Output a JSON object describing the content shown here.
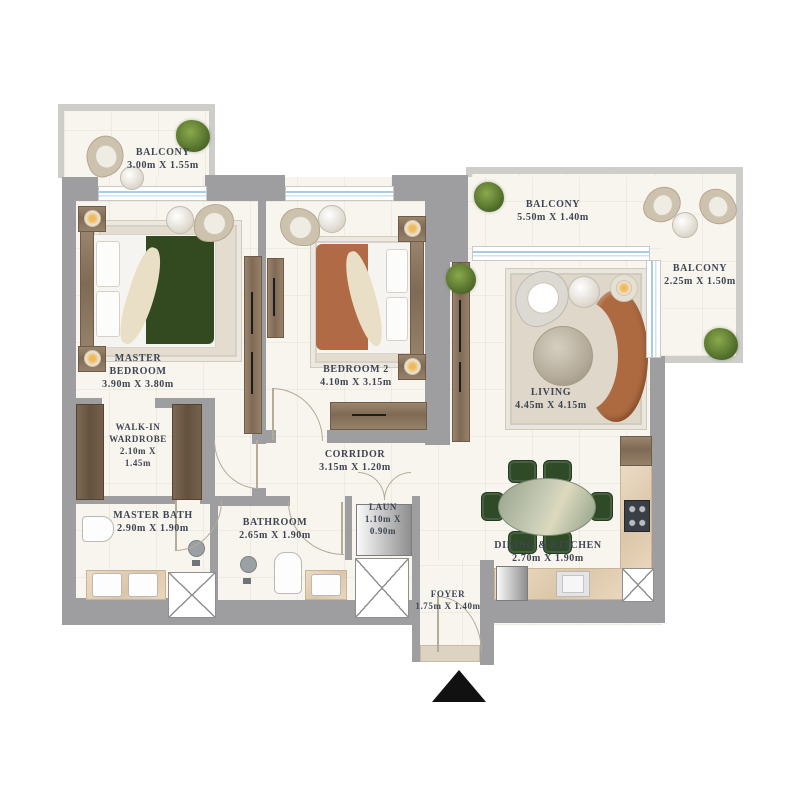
{
  "plan_title": "2 Bedroom Apartment Floor Plan",
  "colors": {
    "wall": "#9e9ea0",
    "balcony_wall": "#cecdca",
    "floor": "#f8f4ee",
    "text": "#3e4653",
    "window_blue": "#a9cbe4",
    "wood": "#8a7460",
    "master_bed_blanket_green": "#33491f",
    "bedroom2_blanket_terracotta": "#b06a45",
    "sofa_terracotta": "#ad6a40",
    "dining_chair_green": "#2e4a27",
    "marble_counter": "#e4d3ba",
    "entrance_marker": "#111111"
  },
  "rooms": {
    "balcony_top_left": {
      "name": "BALCONY",
      "dims": "3.00m X 1.55m"
    },
    "master_bedroom": {
      "name_line1": "MASTER",
      "name_line2": "BEDROOM",
      "dims": "3.90m X 3.80m"
    },
    "bedroom_2": {
      "name": "BEDROOM 2",
      "dims": "4.10m X 3.15m"
    },
    "balcony_top_right": {
      "name": "BALCONY",
      "dims": "5.50m X 1.40m"
    },
    "balcony_right": {
      "name": "BALCONY",
      "dims": "2.25m X 1.50m"
    },
    "living": {
      "name": "LIVING",
      "dims": "4.45m X 4.15m"
    },
    "walk_in_wardrobe": {
      "name_line1": "WALK-IN",
      "name_line2": "WARDROBE",
      "dims_line1": "2.10m X",
      "dims_line2": "1.45m"
    },
    "corridor": {
      "name": "CORRIDOR",
      "dims": "3.15m X 1.20m"
    },
    "master_bath": {
      "name": "MASTER BATH",
      "dims": "2.90m X 1.90m"
    },
    "bathroom": {
      "name": "BATHROOM",
      "dims": "2.65m X 1.90m"
    },
    "laundry": {
      "name": "LAUN",
      "dims_line1": "1.10m X",
      "dims_line2": "0.90m"
    },
    "dining_kitchen": {
      "name": "DINING & KITCHEN",
      "dims": "2.70m X 1.90m"
    },
    "foyer": {
      "name": "FOYER",
      "dims": "1.75m X 1.40m"
    }
  },
  "icons": {
    "entrance_marker": "black up-pointing triangle at unit entry",
    "service_shaft": "white square with X cross",
    "door_swing": "quarter-circle arc",
    "window": "double light-blue line in white frame",
    "plant": "green round shrub (4 on balconies/living)",
    "beds": "master bed green blanket, bedroom 2 terracotta blanket",
    "sofa": "terracotta crescent sofa",
    "dining_table": "green marble oval with 6 green chairs",
    "kitchen": "hob, sink, fridge along L-counter",
    "bathrooms": "toilet, basin, shower head icons",
    "washer": "grey gradient box in laundry"
  }
}
